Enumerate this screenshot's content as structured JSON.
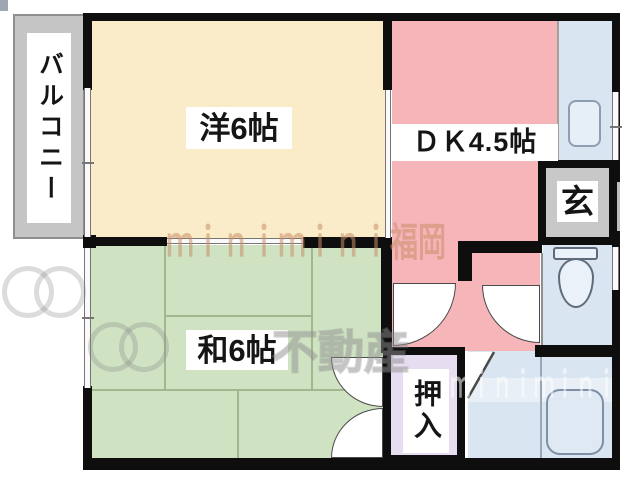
{
  "plan_title": "2DK apartment floor plan",
  "rooms": {
    "balcony": {
      "label": "バルコニー"
    },
    "western_room": {
      "label": "洋6帖"
    },
    "dining_kitchen": {
      "label": "ＤＫ4.5帖"
    },
    "entrance": {
      "label": "玄"
    },
    "japanese_room": {
      "label": "和6帖"
    },
    "closet": {
      "label": "押入"
    }
  },
  "watermarks": {
    "brand_center": "ｍｉｎｉｍｉｎｉ福岡",
    "agency": "不動産",
    "brand_lower": "ｍｉｎｉｍｉｎｉ"
  },
  "colors": {
    "western_room": "#faecc9",
    "dining_kitchen": "#f5b5b9",
    "japanese_room": "#cfe3c3",
    "closet": "#e6ddf0",
    "water_area": "#d9e5f1",
    "entrance_floor": "#c8c8c8",
    "balcony_floor": "#c5c5c5",
    "wall": "#0e0e0e",
    "tatami_line": "#9fb890"
  }
}
